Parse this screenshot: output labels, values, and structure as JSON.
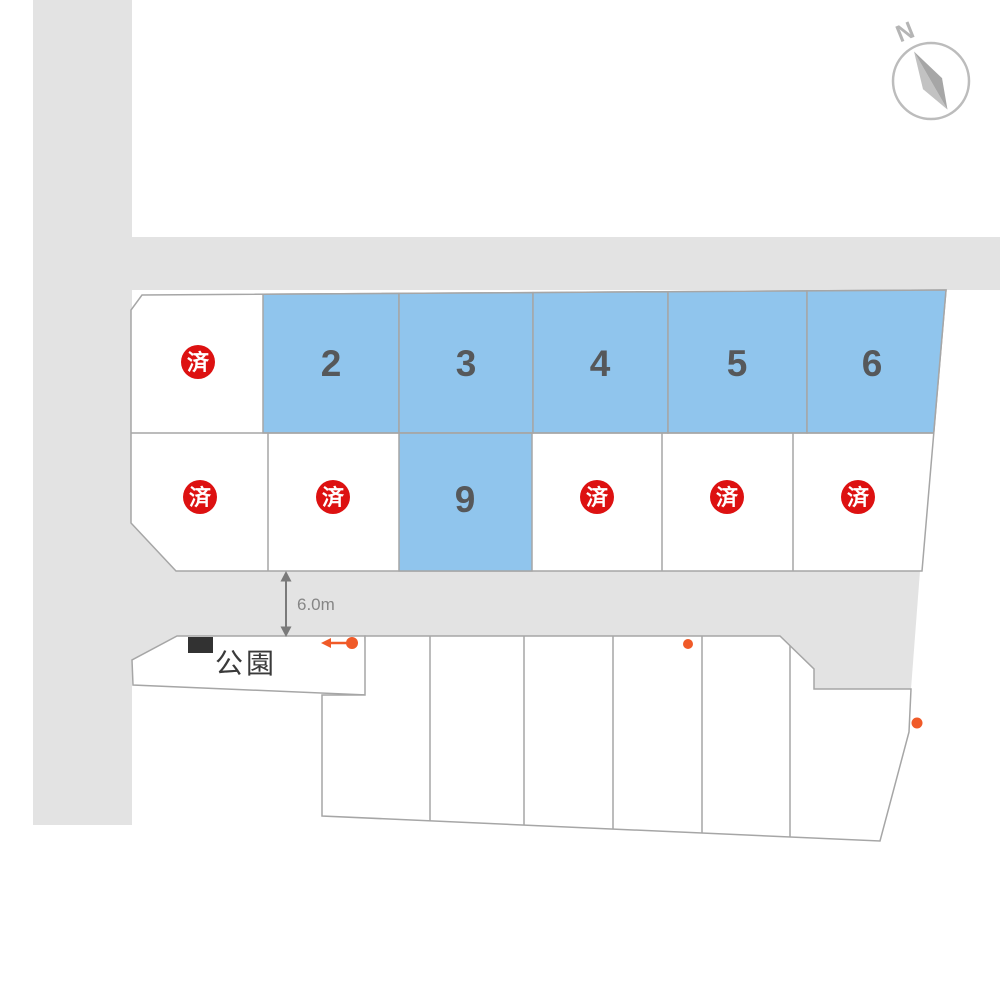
{
  "map": {
    "compass": {
      "north_label": "N"
    },
    "road": {
      "width_label": "6.0m"
    },
    "park": {
      "label": "公園"
    },
    "legend": {
      "sold_mark": "済"
    },
    "lots": {
      "row1": [
        {
          "id": "r1c1",
          "status": "sold"
        },
        {
          "id": "r1c2",
          "status": "available",
          "number": "2"
        },
        {
          "id": "r1c3",
          "status": "available",
          "number": "3"
        },
        {
          "id": "r1c4",
          "status": "available",
          "number": "4"
        },
        {
          "id": "r1c5",
          "status": "available",
          "number": "5"
        },
        {
          "id": "r1c6",
          "status": "available",
          "number": "6"
        }
      ],
      "row2": [
        {
          "id": "r2c1",
          "status": "sold"
        },
        {
          "id": "r2c2",
          "status": "sold"
        },
        {
          "id": "r2c3",
          "status": "available",
          "number": "9"
        },
        {
          "id": "r2c4",
          "status": "sold"
        },
        {
          "id": "r2c5",
          "status": "sold"
        },
        {
          "id": "r2c6",
          "status": "sold"
        }
      ],
      "bottom_row": {
        "unlabeled_lot_count": 6
      }
    },
    "colors": {
      "available_lot_fill": "#90c5ed",
      "sold_badge_red": "#dd1111",
      "road_gray": "#e3e3e3",
      "marker_orange": "#f05a28",
      "lot_border_gray": "#a6a6a6"
    }
  }
}
